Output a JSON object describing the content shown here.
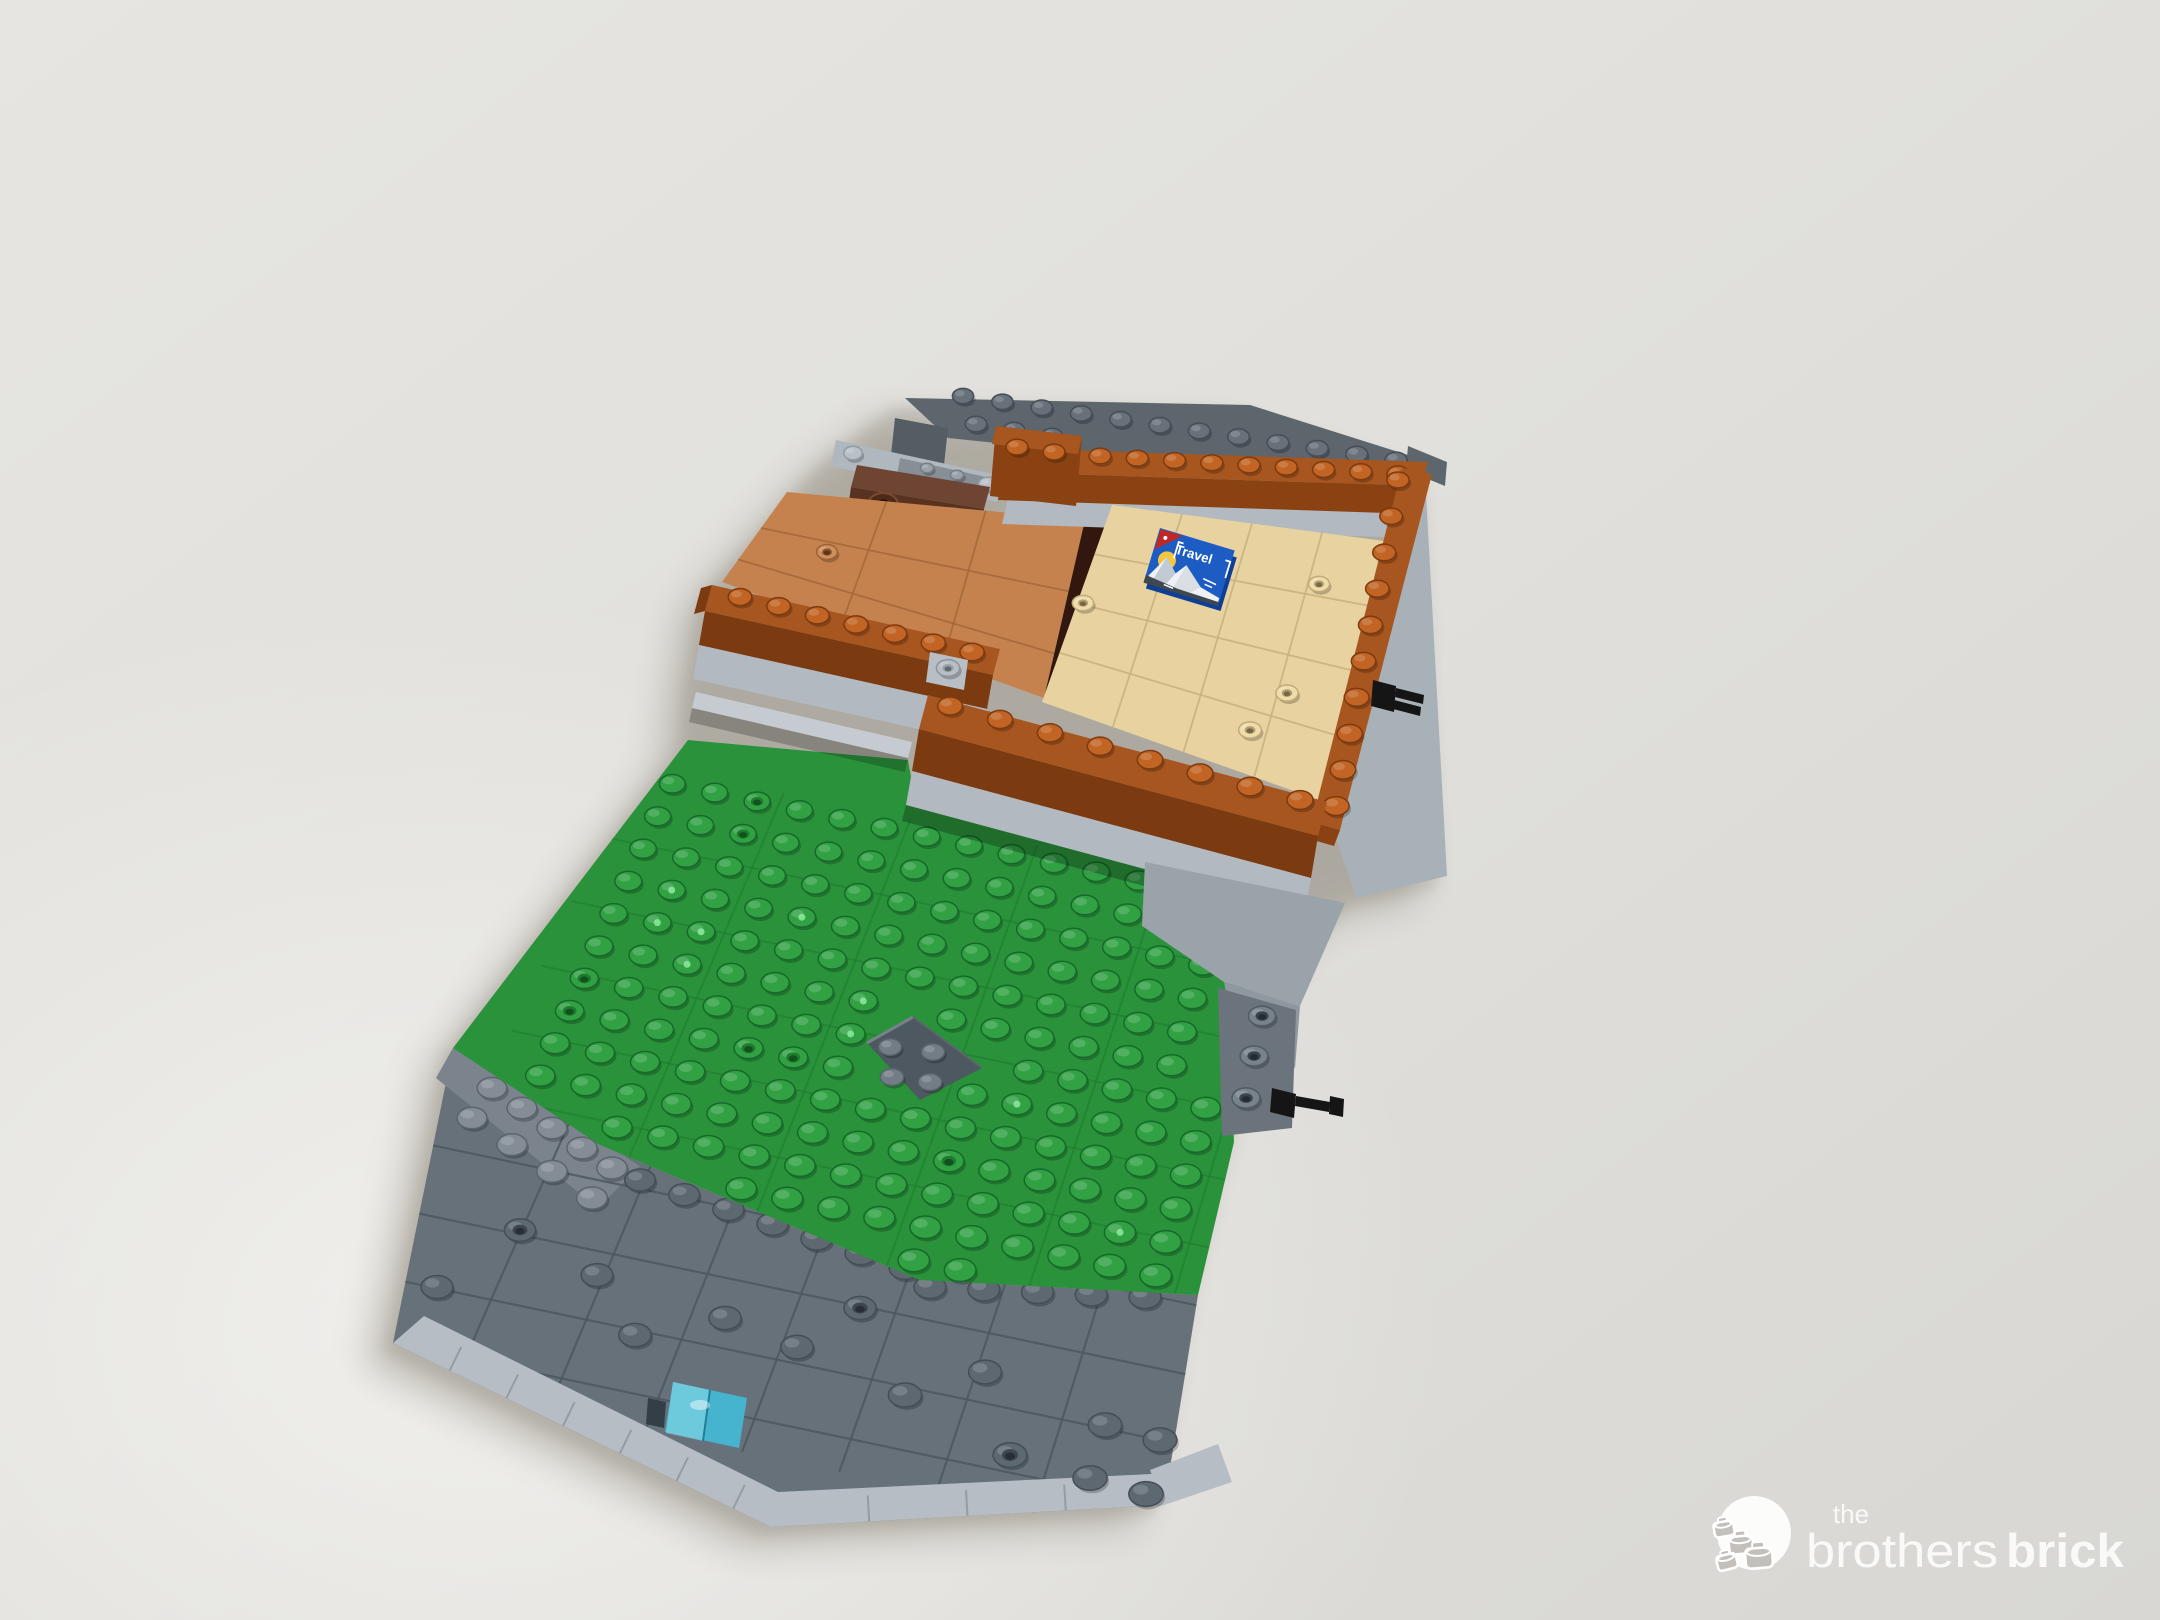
{
  "image": {
    "type": "photograph",
    "subject": "LEGO modular building base section, work in progress, on a light gray studio backdrop"
  },
  "travel_tile": {
    "label": "Travel"
  },
  "watermark": {
    "the": "the",
    "brothers": "brothers",
    "brick": "brick"
  },
  "colors": {
    "backdrop_light": "#efeeea",
    "backdrop_mid": "#e3e2de",
    "backdrop_dark": "#d6d5d1",
    "shadow": "#8f897d",
    "top_plate": "#5d656d",
    "top_plate_tile": "#545c64",
    "plate_stud": "#68717a",
    "plate_stud_rim": "#454e56",
    "light_bar": "#b0b8bf",
    "light_bar_inset": "#868e96",
    "reddish_top": "#6e4433",
    "reddish_face": "#5a3222",
    "cyl": "#4e2a19",
    "cyl_hole": "#1f0c05",
    "nougat": "#c5824e",
    "nougat_groove": "#a2663a",
    "nougat_stud": "#cd8f5c",
    "dark_brown": "#31170d",
    "tan": "#e7d2a0",
    "tan_groove": "#c9b27f",
    "tan_stud": "#eedcab",
    "tan_hole": "#b59e6f",
    "orange_top": "#a8561f",
    "orange_face": "#8a4213",
    "orange_face_dark": "#7c3a10",
    "orange_stud": "#c26524",
    "orange_rim": "#7c3a10",
    "gray_wall": "#b2b9c0",
    "gray_wall_light": "#c5cbd1",
    "gray_edge": "#a9b1b8",
    "gray_edge_dark": "#5d656d",
    "gray_step": "#9aa2aa",
    "gray_step_dark": "#8f979f",
    "side_brick": "#6b747c",
    "side_stud": "#78828a",
    "side_hole": "#3a444c",
    "green": "#2a923b",
    "green_stud": "#31a144",
    "green_rim": "#17692a",
    "green_groove": "#1d7a2e",
    "green_dot": "#8ae79b",
    "diamond": "#4e5860",
    "diamond_stud": "#737d86",
    "walk": "#67717a",
    "walk_light": "#7b848c",
    "walk_stud": "#5e6870",
    "walk_stud_light": "#848d95",
    "walk_groove": "#4e5861",
    "curb": "#b6bdc4",
    "curb_groove": "#949ca4",
    "trans_blue": "#45b7d4",
    "trans_blue_light": "#8edcea",
    "slot_dark": "#343e46",
    "black": "#151515",
    "travel_blue": "#1d5cc2",
    "travel_blue_side": "#0e3f95",
    "travel_red": "#c02828",
    "travel_sun": "#f2c63e",
    "travel_white": "#eef1f5",
    "travel_shade": "#bcc6d0",
    "travel_road": "#3f474f",
    "logo_white": "#fdfdfc",
    "logo_gray": "#c3c0bb"
  }
}
